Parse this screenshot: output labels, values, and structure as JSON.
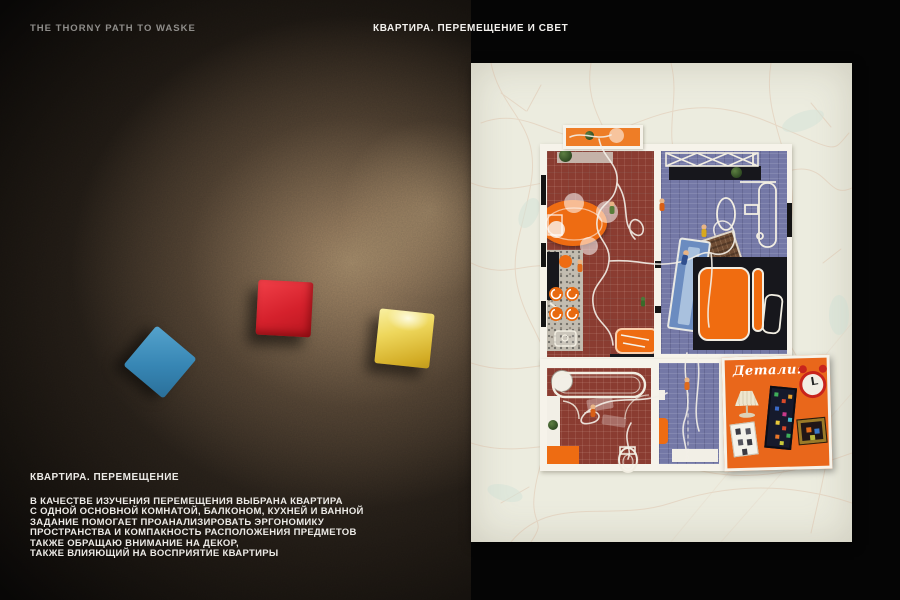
{
  "header": {
    "left_title": "THE THORNY PATH TO WASKE",
    "center_title": "КВАРТИРА. ПЕРЕМЕЩЕНИЕ И СВЕТ"
  },
  "caption": {
    "title": "КВАРТИРА. ПЕРЕМЕЩЕНИЕ",
    "lines": [
      "В КАЧЕСТВЕ ИЗУЧЕНИЯ ПЕРЕМЕЩЕНИЯ ВЫБРАНА КВАРТИРА",
      "С ОДНОЙ ОСНОВНОЙ КОМНАТОЙ, БАЛКОНОМ, КУХНЕЙ И ВАННОЙ",
      "ЗАДАНИЕ ПОМОГАЕТ ПРОАНАЛИЗИРОВАТЬ ЭРГОНОМИКУ",
      "ПРОСТРАНСТВА И КОМПАКНОСТЬ РАСПОЛОЖЕНИЯ ПРЕДМЕТОВ",
      "ТАКЖЕ ОБРАЩАЮ ВНИМАНИЕ НА ДЕКОР,",
      "ТАКЖЕ ВЛИЯЮЩИЙ НА ВОСПРИЯТИЕ КВАРТИРЫ"
    ]
  },
  "photo_tiles": [
    {
      "name": "blue-tile",
      "color": "#3E8FBE"
    },
    {
      "name": "red-tile",
      "color": "#D6202D"
    },
    {
      "name": "yellow-tile",
      "color": "#E3C52F"
    }
  ],
  "floor_plan": {
    "details_card_label": "Детали:",
    "colors": {
      "panel_background": "#ECECDF",
      "kitchen_floor": "#8A3C31",
      "bedroom_floor": "#7478A6",
      "accent_orange": "#ED6C15",
      "trace_line": "#F4F0E8"
    }
  }
}
